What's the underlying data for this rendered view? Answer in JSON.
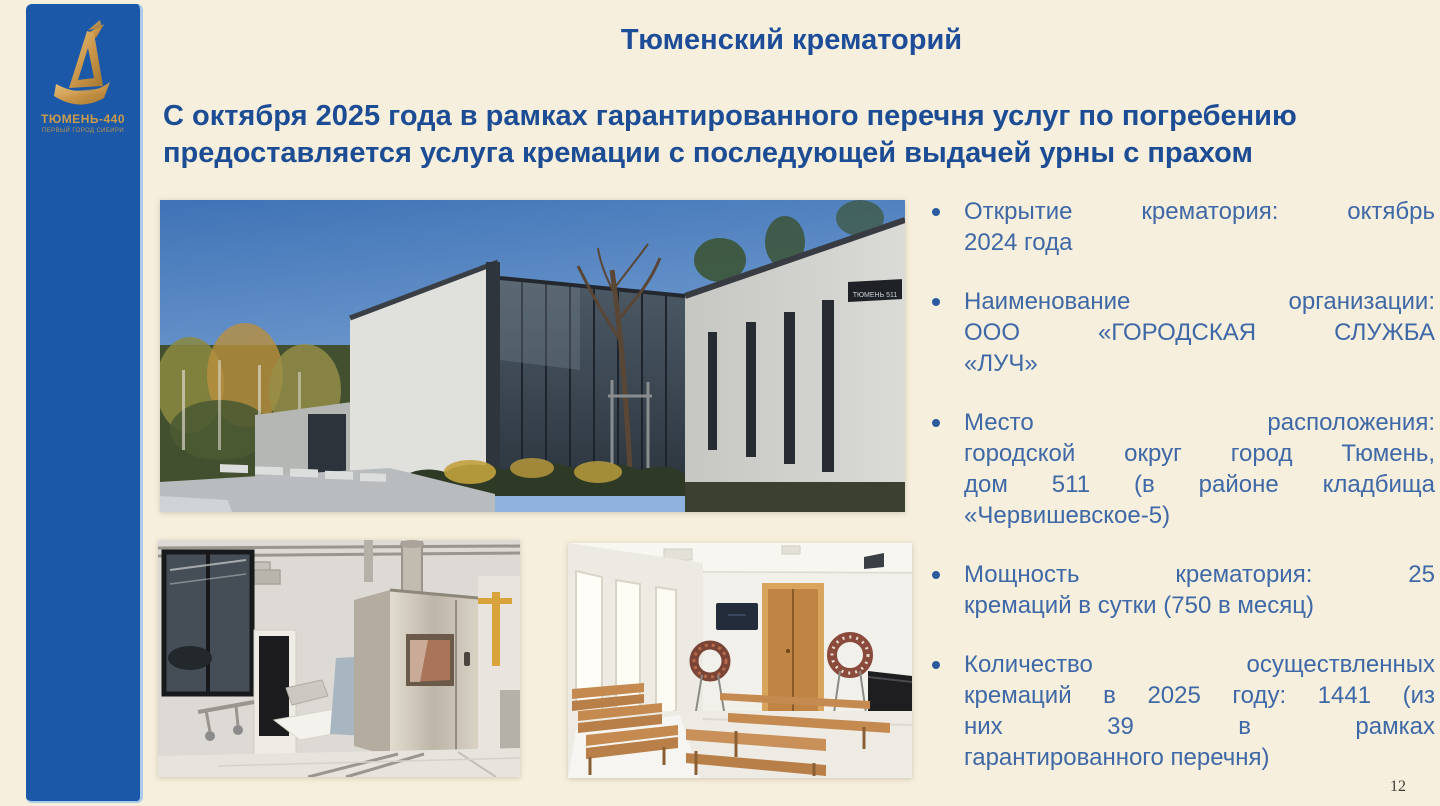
{
  "slide": {
    "title": "Тюменский крематорий",
    "subtitle_line1": "С октября 2025 года в рамках гарантированного перечня услуг по погребению",
    "subtitle_line2": "предоставляется услуга кремации с последующей выдачей урны с прахом",
    "page_number": "12",
    "background_color": "#f6efdd",
    "title_color": "#1d4d99",
    "bullet_text_color": "#3e68a6"
  },
  "sidebar": {
    "bar_color": "#1b58a8",
    "logo": {
      "icon": "ship-emblem-icon",
      "gold_color": "#c99b4a",
      "title": "ТЮМЕНЬ-440",
      "tagline": "ПЕРВЫЙ ГОРОД СИБИРИ"
    }
  },
  "photos": {
    "0": {
      "name": "crematorium-building-exterior",
      "sign_text": "ТЮМЕНЬ 511"
    },
    "1": {
      "name": "cremation-furnace-room"
    },
    "2": {
      "name": "farewell-hall-interior"
    }
  },
  "bullets": {
    "0": {
      "text": "Открытие крематория: октябрь 2024 года",
      "lines": [
        "Открытие крематория: октябрь",
        "2024 года"
      ]
    },
    "1": {
      "text": "Наименование организации: ООО «ГОРОДСКАЯ СЛУЖБА «ЛУЧ»",
      "lines": [
        "Наименование организации:",
        "ООО «ГОРОДСКАЯ СЛУЖБА",
        "«ЛУЧ»"
      ]
    },
    "2": {
      "text": "Место расположения: городской округ город Тюмень, дом 511 (в районе кладбища «Червишевское-5)",
      "lines": [
        "Место расположения:",
        "городской округ город Тюмень,",
        "дом 511 (в районе кладбища",
        "«Червишевское-5)"
      ]
    },
    "3": {
      "text": "Мощность крематория: 25 кремаций в сутки (750 в месяц)",
      "lines": [
        "Мощность крематория: 25",
        "кремаций в сутки (750 в месяц)"
      ]
    },
    "4": {
      "text": "Количество осуществленных кремаций в 2025 году: 1441 (из них 39 в рамках гарантированного перечня)",
      "lines": [
        "Количество осуществленных",
        "кремаций в 2025 году: 1441 (из",
        "них 39 в рамках",
        "гарантированного перечня)"
      ]
    }
  }
}
